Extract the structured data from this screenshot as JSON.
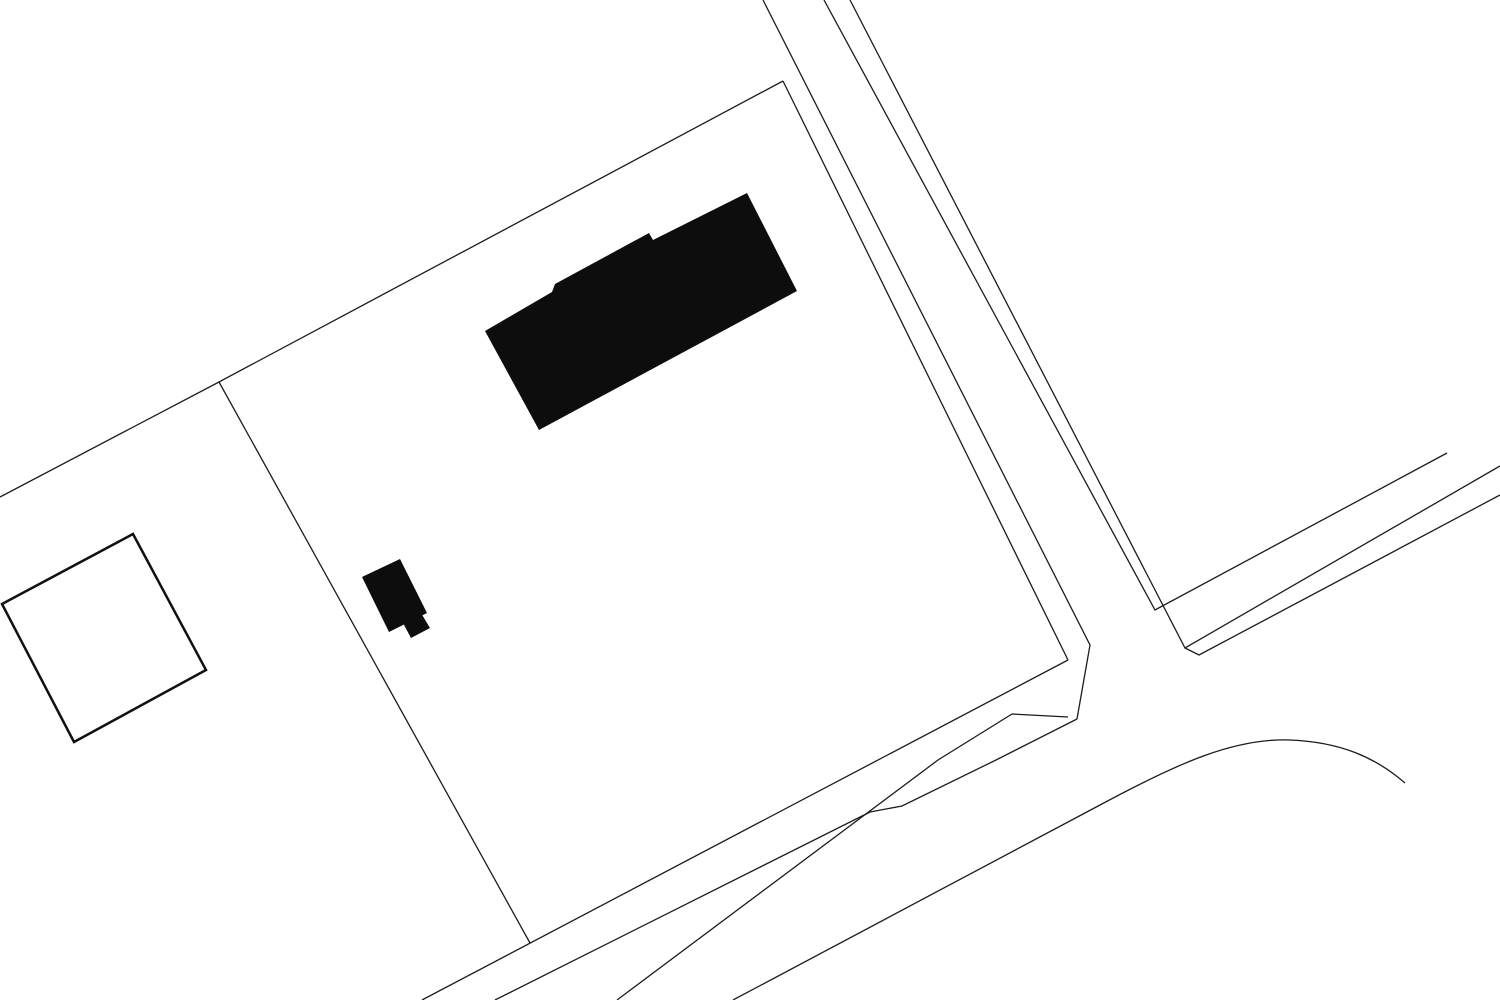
{
  "canvas": {
    "width": 1500,
    "height": 1000,
    "background": "#ffffff"
  },
  "palette": {
    "boundary_line": "#1c1c1c",
    "road_line": "#1c1c1c",
    "building_fill": "#0d0d0d",
    "emphasized_parcel_stroke": "#111111"
  },
  "stroke_widths": {
    "boundary": 1.3,
    "road": 1.3,
    "emphasized_parcel": 2.5
  },
  "map": {
    "buildings": [
      {
        "name": "large-building-footprint",
        "points": [
          [
            747,
            193
          ],
          [
            797,
            291
          ],
          [
            539,
            430
          ],
          [
            485,
            331
          ],
          [
            552,
            292
          ],
          [
            555,
            284
          ],
          [
            649,
            233
          ],
          [
            653,
            240
          ]
        ]
      },
      {
        "name": "small-building-footprint-main",
        "points": [
          [
            400,
            559
          ],
          [
            427,
            613
          ],
          [
            389,
            632
          ],
          [
            362,
            577
          ]
        ]
      },
      {
        "name": "small-building-footprint-annex",
        "points": [
          [
            421,
            613
          ],
          [
            430,
            628
          ],
          [
            411,
            638
          ],
          [
            403,
            623
          ]
        ]
      }
    ],
    "parcel_boundaries": [
      {
        "name": "block-boundary-northwest",
        "points": [
          [
            0,
            497
          ],
          [
            219,
            382
          ],
          [
            783,
            81
          ]
        ]
      },
      {
        "name": "parcel-west-edge",
        "points": [
          [
            219,
            382
          ],
          [
            530,
            943
          ]
        ]
      },
      {
        "name": "parcel-south-edge",
        "points": [
          [
            1068,
            660
          ],
          [
            422,
            1000
          ]
        ]
      },
      {
        "name": "parcel-east-edge",
        "points": [
          [
            783,
            81
          ],
          [
            1068,
            660
          ]
        ]
      }
    ],
    "road_edges": [
      {
        "name": "road-north-west-edge",
        "points": [
          [
            763,
            0
          ],
          [
            1090,
            645
          ],
          [
            1077,
            719
          ]
        ]
      },
      {
        "name": "road-north-east-edge",
        "points": [
          [
            824,
            0
          ],
          [
            1155,
            610
          ],
          [
            1447,
            453
          ]
        ]
      },
      {
        "name": "road-east-outer-edge",
        "points": [
          [
            850,
            0
          ],
          [
            1185,
            648
          ],
          [
            1500,
            466
          ]
        ]
      },
      {
        "name": "road-east-chamfer-edge",
        "points": [
          [
            1185,
            648
          ],
          [
            1199,
            655
          ],
          [
            1500,
            495
          ]
        ]
      },
      {
        "name": "road-south-north-edge",
        "points": [
          [
            495,
            1000
          ],
          [
            870,
            812
          ],
          [
            902,
            806
          ],
          [
            996,
            760
          ],
          [
            1077,
            719
          ]
        ]
      },
      {
        "name": "road-south-south-edge",
        "points": [
          [
            617,
            1000
          ],
          [
            938,
            760
          ],
          [
            1012,
            714
          ],
          [
            1068,
            717
          ]
        ]
      }
    ],
    "curved_edges": [
      {
        "name": "road-curve-southeast",
        "d": "M 733 1000 L 1100 805 C 1180 762 1235 738 1290 740 C 1340 742 1375 757 1405 783"
      }
    ],
    "emphasized_parcel": {
      "name": "square-parcel-outline",
      "points": [
        [
          2,
          604
        ],
        [
          133,
          534
        ],
        [
          206,
          670
        ],
        [
          74,
          742
        ]
      ]
    }
  }
}
